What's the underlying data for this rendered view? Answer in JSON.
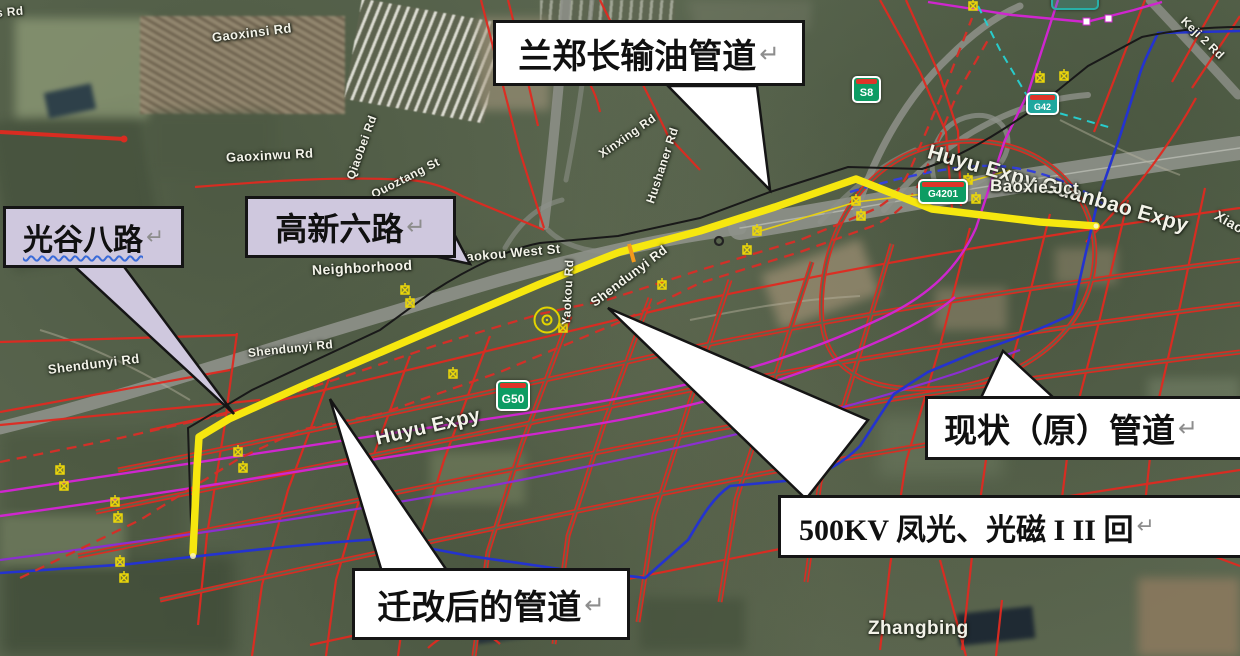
{
  "map": {
    "callouts": {
      "lanzhengchang": {
        "label": "兰郑长输油管道",
        "return_mark": "↵",
        "bg": "#ffffff"
      },
      "guanggu": {
        "label": "光谷八路",
        "return_mark": "↵",
        "bg": "#cfc8de",
        "underline": "wavy-blue"
      },
      "gaoxin": {
        "label": "高新六路",
        "return_mark": "↵",
        "bg": "#cfc8de"
      },
      "existing": {
        "label": "现状（原）管道",
        "return_mark": "↵",
        "bg": "#ffffff"
      },
      "kv500": {
        "label": "500KV 凤光、光磁 I II 回",
        "return_mark": "↵",
        "bg": "#ffffff"
      },
      "relocated": {
        "label": "迁改后的管道",
        "return_mark": "↵",
        "bg": "#ffffff"
      }
    },
    "labels": [
      {
        "text": "s Rd"
      },
      {
        "text": "Gaoxinsi Rd"
      },
      {
        "text": "Gaoxinwu Rd"
      },
      {
        "text": "Qiaobei Rd"
      },
      {
        "text": "Quoztang St"
      },
      {
        "text": "Neighborhood"
      },
      {
        "text": "Yaokou West St"
      },
      {
        "text": "Yaokou Rd"
      },
      {
        "text": "Shendunyi Rd"
      },
      {
        "text": "Shendunyi Rd"
      },
      {
        "text": "Shendunyi Rd"
      },
      {
        "text": "Hushaner Rd"
      },
      {
        "text": "Xinxing Rd"
      },
      {
        "text": "Huyu Expy"
      },
      {
        "text": "Huyu Expy Guanbao Expy"
      },
      {
        "text": "Baoxie Jct"
      },
      {
        "text": "Keji 2 Rd"
      },
      {
        "text": "Xiao"
      },
      {
        "text": "Zhangbing"
      }
    ],
    "shields": [
      {
        "text": "S8"
      },
      {
        "text": "G4201"
      },
      {
        "text": "G42"
      },
      {
        "text": "G50"
      }
    ],
    "line_legend": {
      "relocated_pipeline_yellow": "#f6e70f",
      "oil_pipeline_black": "#191919",
      "original_pipeline_red_dashed": "#d23028",
      "planned_road_grid_red": "#e02a20",
      "transmission_magenta": "#cf26cf",
      "river_blue": "#2433cf",
      "cyan_dashed": "#28cccc",
      "purple_line": "#8b2fd0"
    }
  }
}
